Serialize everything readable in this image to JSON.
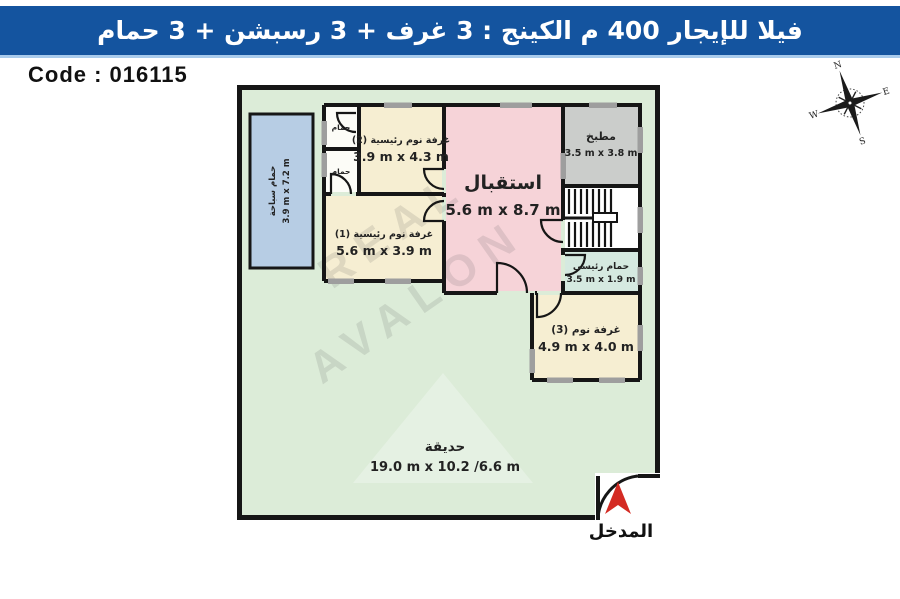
{
  "title_bar": {
    "text": "فيلا للإيجار 400 م الكينج :  3 غرف + 3 رسبشن + 3 حمام",
    "bg_color": "#14549f",
    "text_color": "#ffffff"
  },
  "code_box": {
    "text": "Code : 016115"
  },
  "compass": {
    "north": "N",
    "east": "E",
    "south": "S",
    "west": "W"
  },
  "watermark": {
    "line1": "REAL",
    "line2": "AVALON"
  },
  "plan": {
    "wall_color": "#161616",
    "garden": {
      "name": "حديقة",
      "dims": "19.0 m x 10.2 /6.6 m",
      "color": "#dcecd8"
    },
    "entrance_label": "المدخل",
    "rooms": {
      "pool": {
        "name": "حمام سباحة",
        "dims": "3.9 m x 7.2 m",
        "color": "#b7cde4"
      },
      "bath_top": {
        "name": "حمام",
        "color": "#fcfcf7"
      },
      "bath_bottom": {
        "name": "حمام",
        "color": "#fcfcf7"
      },
      "bed2": {
        "name": "غرفة نوم رئيسية (2)",
        "dims": "3.9 m x 4.3 m",
        "color": "#f6eed2"
      },
      "bed1": {
        "name": "غرفة نوم رئيسية (1)",
        "dims": "5.6 m x 3.9 m",
        "color": "#f6eed2"
      },
      "reception": {
        "name": "استقبال",
        "dims": "5.6 m x 8.7 m",
        "color": "#f6d3d8"
      },
      "kitchen": {
        "name": "مطبخ",
        "dims": "3.5 m x 3.8 m",
        "color": "#cbcdcb"
      },
      "master_bath": {
        "name": "حمام رئيسي",
        "dims": "3.5 m x 1.9 m",
        "color": "#d5e9e0"
      },
      "bed3": {
        "name": "غرفة نوم (3)",
        "dims": "4.9 m x 4.0 m",
        "color": "#f6eed2"
      }
    }
  }
}
